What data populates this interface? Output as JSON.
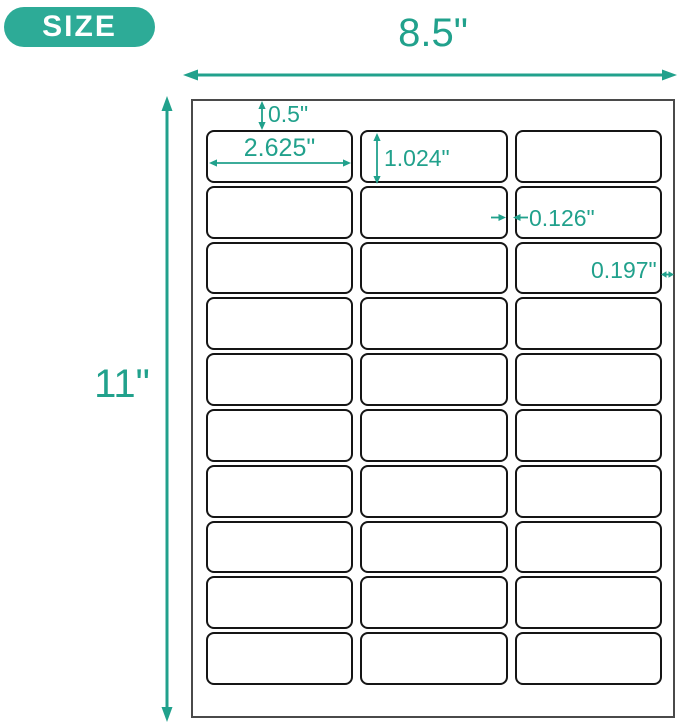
{
  "badge": {
    "label": "SIZE"
  },
  "sheet": {
    "columns": 3,
    "rows": 10,
    "label_count": 30
  },
  "annotations": {
    "page_width": "8.5\"",
    "page_height": "11\"",
    "top_margin": "0.5\"",
    "label_width": "2.625\"",
    "label_height": "1.024\"",
    "column_gap": "0.126\"",
    "right_margin": "0.197\""
  },
  "colors": {
    "accent_teal": "#21A18C",
    "badge_teal": "#2DAB97",
    "label_border": "#151515",
    "sheet_border": "#4A4A4A"
  }
}
